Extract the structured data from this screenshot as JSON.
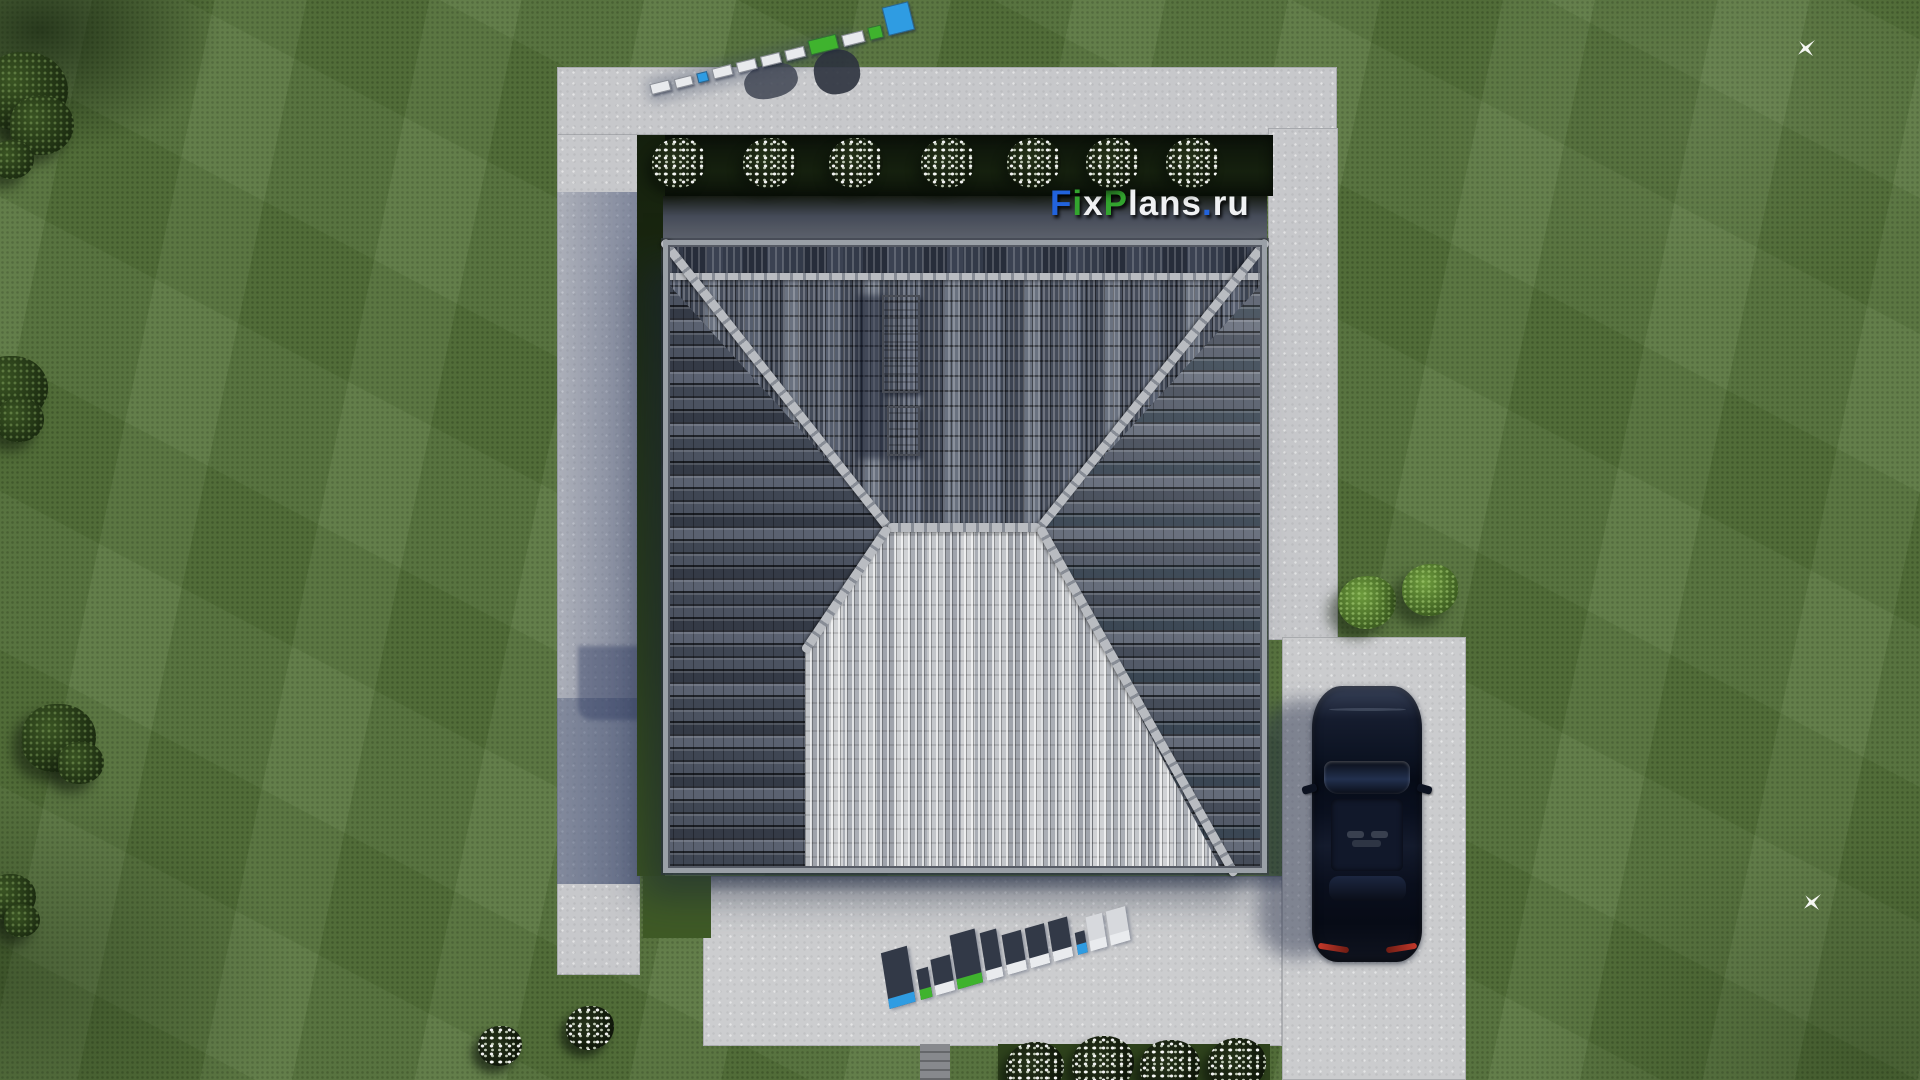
{
  "brand": {
    "name": "FixPlans.ru",
    "colors": {
      "blue": "#2263dc",
      "green": "#33a52f",
      "white": "#f0f1f3"
    }
  },
  "logo": {
    "parts": [
      {
        "text": "F",
        "color": "#2263dc"
      },
      {
        "text": "i",
        "color": "#33a52f"
      },
      {
        "text": "x",
        "color": "#f0f1f3"
      },
      {
        "text": "P",
        "color": "#33a52f"
      },
      {
        "text": "lans",
        "color": "#f0f1f3"
      },
      {
        "text": ".",
        "color": "#2263dc"
      },
      {
        "text": "ru",
        "color": "#f0f1f3"
      }
    ]
  },
  "watermarks": {
    "path_standing": {
      "label": "FixPlans.ru",
      "slabs": [
        {
          "w": 18,
          "h": 9,
          "face": "#e8eaed"
        },
        {
          "w": 16,
          "h": 8,
          "face": "#e8eaed"
        },
        {
          "w": 9,
          "h": 8,
          "face": "#2f9ce2"
        },
        {
          "w": 18,
          "h": 9,
          "face": "#e8eaed"
        },
        {
          "w": 18,
          "h": 9,
          "face": "#e8eaed"
        },
        {
          "w": 18,
          "h": 9,
          "face": "#e8eaed"
        },
        {
          "w": 18,
          "h": 9,
          "face": "#e8eaed"
        },
        {
          "w": 27,
          "h": 13,
          "face": "#3fb32e"
        },
        {
          "w": 20,
          "h": 10,
          "face": "#e8eaed"
        },
        {
          "w": 12,
          "h": 11,
          "face": "#3fb32e"
        },
        {
          "w": 25,
          "h": 27,
          "face": "#2f9ce2"
        }
      ]
    },
    "terrace_flat": {
      "label": "FixPlans.ru",
      "slabs": [
        {
          "w": 27,
          "h": 46,
          "face": "#2f9ce2"
        },
        {
          "w": 12,
          "h": 20,
          "face": "#3fb32e"
        },
        {
          "w": 20,
          "h": 26,
          "face": "#e9ebee"
        },
        {
          "w": 26,
          "h": 44,
          "face": "#3fb32e"
        },
        {
          "w": 17,
          "h": 38,
          "face": "#e9ebee"
        },
        {
          "w": 20,
          "h": 30,
          "face": "#e9ebee"
        },
        {
          "w": 20,
          "h": 30,
          "face": "#e9ebee"
        },
        {
          "w": 20,
          "h": 30,
          "face": "#e9ebee"
        },
        {
          "w": 10,
          "h": 12,
          "face": "#2f9ce2"
        },
        {
          "w": 17,
          "h": 24,
          "face": "#e9ebee"
        },
        {
          "w": 20,
          "h": 24,
          "face": "#e9ebee"
        }
      ]
    }
  },
  "landscape": {
    "dark_trees": [
      {
        "x": -18,
        "y": 52,
        "d": 86
      },
      {
        "x": 10,
        "y": 96,
        "d": 64
      },
      {
        "x": -8,
        "y": 140,
        "d": 42
      },
      {
        "x": -24,
        "y": 356,
        "d": 72
      },
      {
        "x": -4,
        "y": 398,
        "d": 48
      },
      {
        "x": 22,
        "y": 704,
        "d": 74
      },
      {
        "x": 58,
        "y": 742,
        "d": 46
      },
      {
        "x": -14,
        "y": 874,
        "d": 50
      },
      {
        "x": 4,
        "y": 904,
        "d": 36
      }
    ],
    "bright_bushes": [
      {
        "x": 1338,
        "y": 576,
        "d": 58
      },
      {
        "x": 1402,
        "y": 564,
        "d": 56
      }
    ],
    "hedge_flower_bushes": [
      {
        "x": 652,
        "y": 138,
        "d": 54
      },
      {
        "x": 743,
        "y": 138,
        "d": 54
      },
      {
        "x": 829,
        "y": 138,
        "d": 54
      },
      {
        "x": 921,
        "y": 138,
        "d": 54
      },
      {
        "x": 1007,
        "y": 138,
        "d": 54
      },
      {
        "x": 1086,
        "y": 138,
        "d": 54
      },
      {
        "x": 1166,
        "y": 138,
        "d": 54
      }
    ],
    "ground_flower_bushes": [
      {
        "x": 478,
        "y": 1026,
        "d": 44
      },
      {
        "x": 566,
        "y": 1006,
        "d": 48
      },
      {
        "x": 1006,
        "y": 1042,
        "d": 58
      },
      {
        "x": 1072,
        "y": 1036,
        "d": 62
      },
      {
        "x": 1140,
        "y": 1040,
        "d": 60
      },
      {
        "x": 1208,
        "y": 1038,
        "d": 58
      }
    ],
    "birds": [
      {
        "x": 1798,
        "y": 40
      },
      {
        "x": 1804,
        "y": 894
      }
    ]
  },
  "scene_colors": {
    "lawn": "#57743c",
    "pavement": "#c7c8cb",
    "hedge": "#0c130a",
    "roof_dark_slope": "#3a404c",
    "roof_light_slope": "#b2b5bb",
    "ridge_cap": "#b9bcc1",
    "car_body": "#0c1322",
    "taillight_red": "#c3392b",
    "shadow_blue": "#344269"
  }
}
